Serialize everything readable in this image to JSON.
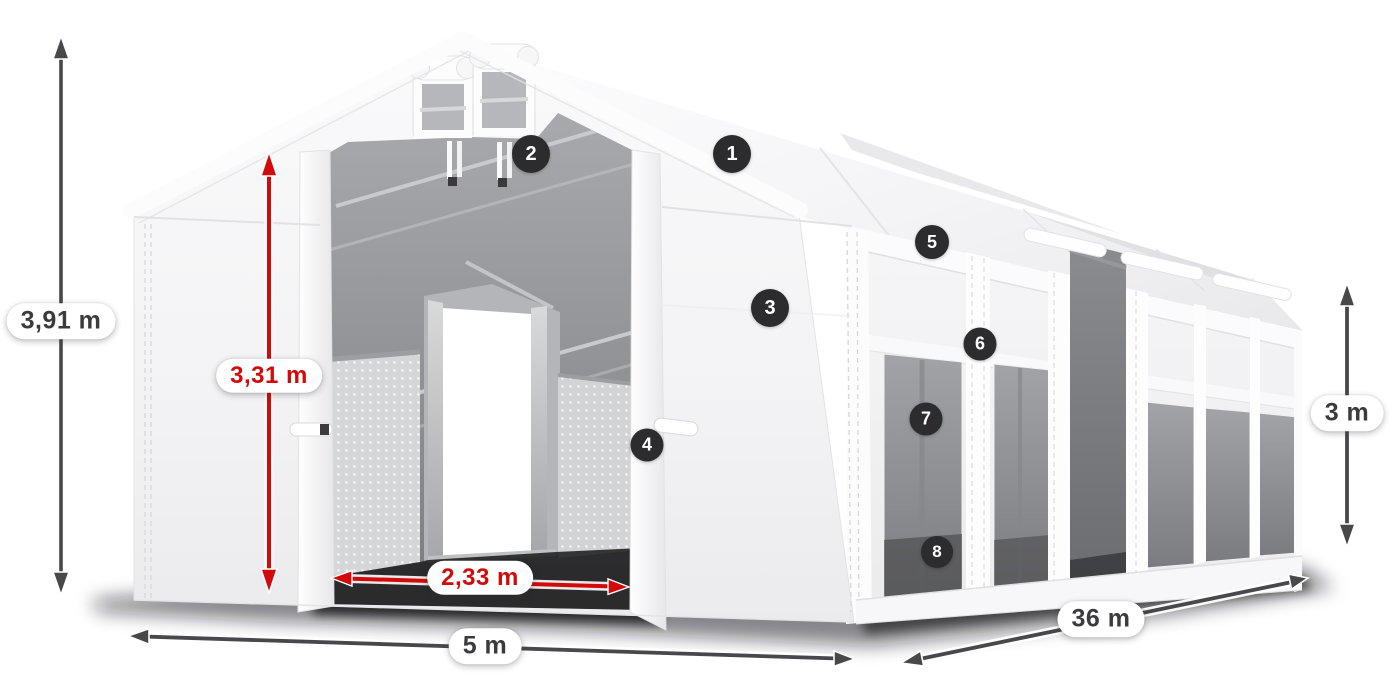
{
  "colors": {
    "background": "#ffffff",
    "dimension_arrow_dark": "#48484b",
    "dimension_arrow_red": "#d20a0a",
    "label_text_dark": "#3b3b3e",
    "label_text_red": "#d10a0a",
    "label_pill_background": "#ffffff",
    "badge_background": "#2c2c2f",
    "badge_text": "#ffffff",
    "tent_white": "#f5f5f7",
    "interior_gray": "#8f9093",
    "window_gray": "#8d8e92"
  },
  "dimensions": {
    "total_height": {
      "label": "3,91 m",
      "style": "dark",
      "orientation": "vertical"
    },
    "inner_height": {
      "label": "3,31 m",
      "style": "red",
      "orientation": "vertical"
    },
    "entrance_width": {
      "label": "2,33 m",
      "style": "red",
      "orientation": "horizontal"
    },
    "width": {
      "label": "5 m",
      "style": "dark",
      "orientation": "horizontal"
    },
    "length": {
      "label": "36 m",
      "style": "dark",
      "orientation": "diagonal"
    },
    "side_height": {
      "label": "3 m",
      "style": "dark",
      "orientation": "vertical"
    }
  },
  "callouts": [
    {
      "number": "1"
    },
    {
      "number": "2"
    },
    {
      "number": "3"
    },
    {
      "number": "4"
    },
    {
      "number": "5"
    },
    {
      "number": "6"
    },
    {
      "number": "7"
    },
    {
      "number": "8"
    }
  ]
}
